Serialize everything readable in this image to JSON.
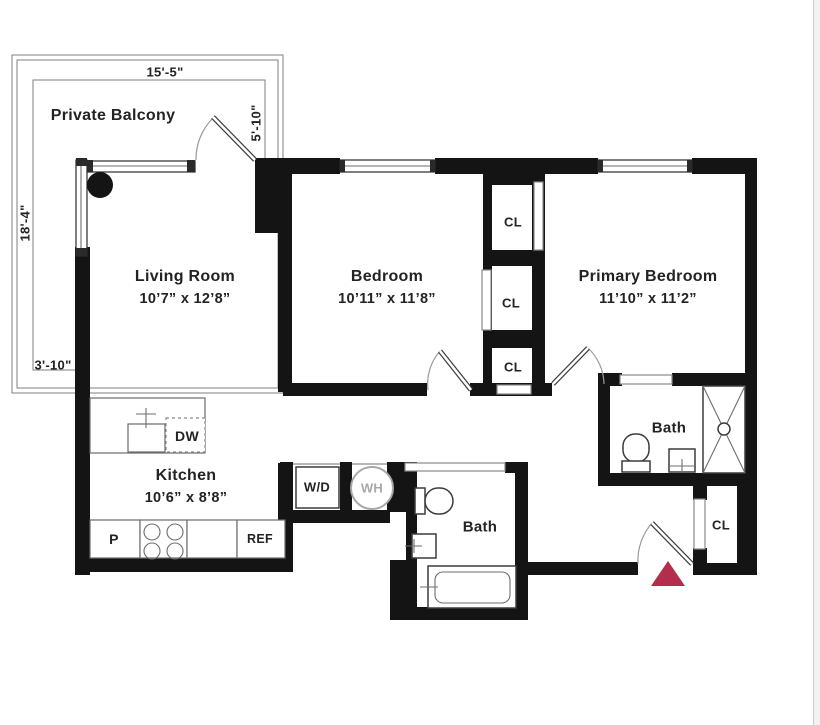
{
  "plan": {
    "balcony": {
      "label": "Private Balcony",
      "dim_top": "15'-5\"",
      "dim_right": "5'-10\"",
      "dim_left": "18'-4\"",
      "dim_bottom": "3'-10\""
    },
    "rooms": {
      "living": {
        "name": "Living Room",
        "dims": "10’7” x 12’8”"
      },
      "bedroom": {
        "name": "Bedroom",
        "dims": "10’11” x 11’8”"
      },
      "primary": {
        "name": "Primary Bedroom",
        "dims": "11’10” x 11’2”"
      },
      "kitchen": {
        "name": "Kitchen",
        "dims": "10’6” x 8’8”"
      },
      "bath_primary": {
        "name": "Bath"
      },
      "bath_hall": {
        "name": "Bath"
      }
    },
    "closets": {
      "cl1": "CL",
      "cl2": "CL",
      "cl3": "CL",
      "foyer": "CL"
    },
    "appliances": {
      "dishwasher": "DW",
      "washer_dryer": "W/D",
      "water_heater": "WH",
      "pantry": "P",
      "fridge": "REF"
    },
    "colors": {
      "wall": "#141414",
      "entry_marker": "#b32d4d",
      "fixture": "#3c3c3c",
      "light": "#a8a8a8",
      "text": "#232323"
    }
  }
}
